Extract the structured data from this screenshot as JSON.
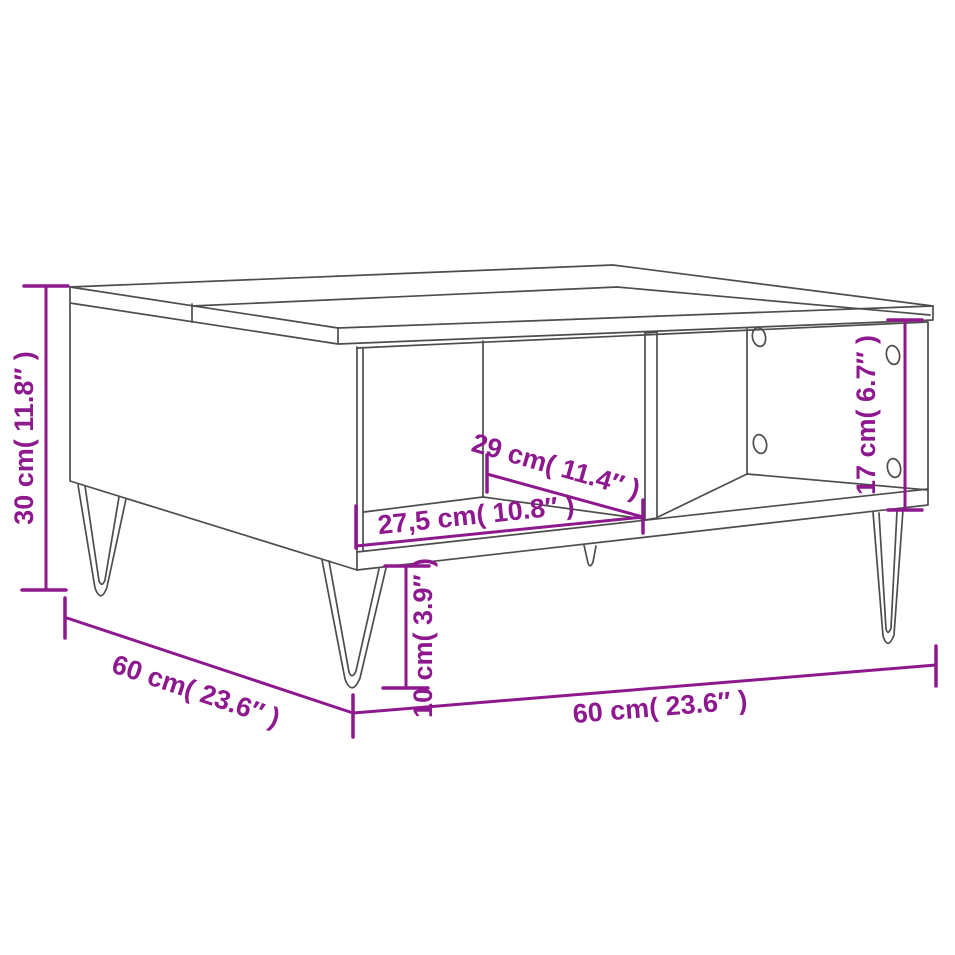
{
  "diagram": {
    "type": "furniture-dimension-diagram",
    "subject": "coffee table with two open compartments and hairpin legs",
    "colors": {
      "dimension_accent": "#8E188E",
      "line_art": "#4d4d4d",
      "background": "#ffffff"
    },
    "dimensions": [
      {
        "name": "overall-height",
        "value_cm": "30",
        "value_inch": "11.8",
        "label": "30 cm( 11.8″ )"
      },
      {
        "name": "overall-depth",
        "value_cm": "60",
        "value_inch": "23.6",
        "label": "60 cm( 23.6″ )"
      },
      {
        "name": "overall-width",
        "value_cm": "60",
        "value_inch": "23.6",
        "label": "60 cm( 23.6″ )"
      },
      {
        "name": "leg-height",
        "value_cm": "10",
        "value_inch": "3.9",
        "label": "10 cm( 3.9″ )"
      },
      {
        "name": "compartment-width",
        "value_cm": "27,5",
        "value_inch": "10.8",
        "label": "27,5 cm( 10.8″ )"
      },
      {
        "name": "compartment-depth",
        "value_cm": "29",
        "value_inch": "11.4",
        "label": "29 cm( 11.4″ )"
      },
      {
        "name": "compartment-height",
        "value_cm": "17",
        "value_inch": "6.7",
        "label": "17 cm( 6.7″ )"
      }
    ]
  }
}
